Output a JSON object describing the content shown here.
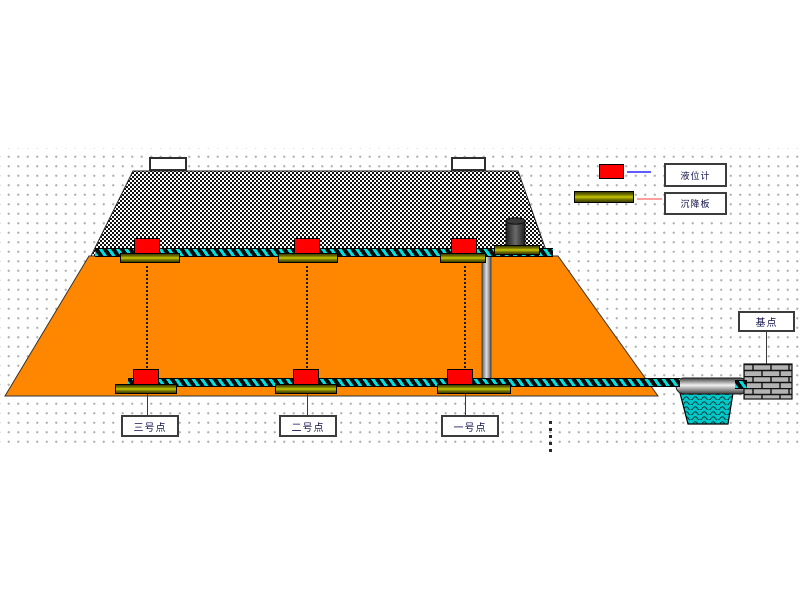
{
  "diagram": {
    "type": "embankment-settlement-monitoring-profile",
    "points": [
      {
        "label": "三号点"
      },
      {
        "label": "二号点"
      },
      {
        "label": "一号点"
      }
    ],
    "benchmark_label": "基点",
    "legend": [
      {
        "label": "液位计",
        "swatch": "red-sensor-box",
        "swatch_color": "#ff0000",
        "line_color": "#5c5cff"
      },
      {
        "label": "沉降板",
        "swatch": "olive-plate-bar",
        "swatch_color": "#9a9a00",
        "line_color": "#ffa0a0"
      }
    ],
    "colors": {
      "embankment_fill": "#ff8700",
      "fill_layer_pattern": "black-white-dither",
      "tube_stripe": "#00dcdc",
      "pool_fill": "#00c8c8",
      "sensor_red": "#ff0000",
      "plate_olive": "#9a9a00",
      "grid_dot": "#b5b5b5"
    }
  }
}
